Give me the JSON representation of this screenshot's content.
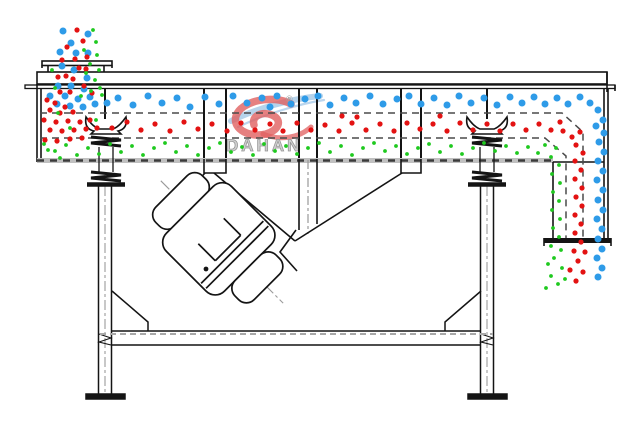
{
  "watermark": {
    "brand": "DAHAN",
    "registered": "®"
  },
  "colors": {
    "line": "#141414",
    "particle_large": "#2E9BE8",
    "particle_medium": "#E31212",
    "particle_small": "#1FC91F",
    "deck_dash": "#4a4a4a",
    "bottom_plate": "#b5b5b5",
    "centerline": "#9a9a9a",
    "watermark_red": "#E06060",
    "watermark_blue": "#A9CBE8",
    "watermark_gray": "#b9b9b9"
  },
  "particles": {
    "large": {
      "r": 3.5,
      "color_key": "particle_large",
      "points": [
        [
          63,
          31
        ],
        [
          88,
          34
        ],
        [
          71,
          43
        ],
        [
          60,
          52
        ],
        [
          76,
          53
        ],
        [
          88,
          53
        ],
        [
          62,
          66
        ],
        [
          74,
          70
        ],
        [
          87,
          78
        ],
        [
          58,
          86
        ],
        [
          71,
          86
        ],
        [
          84,
          89
        ],
        [
          65,
          96
        ],
        [
          78,
          99
        ],
        [
          90,
          97
        ],
        [
          57,
          104
        ],
        [
          70,
          106
        ],
        [
          83,
          107
        ],
        [
          95,
          104
        ],
        [
          107,
          103
        ],
        [
          50,
          96
        ],
        [
          118,
          98
        ],
        [
          133,
          105
        ],
        [
          148,
          96
        ],
        [
          162,
          103
        ],
        [
          177,
          98
        ],
        [
          190,
          107
        ],
        [
          205,
          97
        ],
        [
          219,
          104
        ],
        [
          233,
          96
        ],
        [
          247,
          103
        ],
        [
          262,
          98
        ],
        [
          270,
          107
        ],
        [
          277,
          96
        ],
        [
          291,
          104
        ],
        [
          305,
          99
        ],
        [
          318,
          96
        ],
        [
          330,
          105
        ],
        [
          344,
          98
        ],
        [
          356,
          103
        ],
        [
          370,
          96
        ],
        [
          383,
          104
        ],
        [
          397,
          99
        ],
        [
          409,
          96
        ],
        [
          421,
          104
        ],
        [
          434,
          98
        ],
        [
          447,
          105
        ],
        [
          459,
          96
        ],
        [
          471,
          103
        ],
        [
          484,
          98
        ],
        [
          497,
          105
        ],
        [
          510,
          97
        ],
        [
          522,
          103
        ],
        [
          534,
          97
        ],
        [
          545,
          104
        ],
        [
          557,
          98
        ],
        [
          568,
          104
        ],
        [
          580,
          97
        ],
        [
          590,
          103
        ],
        [
          598,
          110
        ],
        [
          603,
          120
        ],
        [
          596,
          126
        ],
        [
          604,
          133
        ],
        [
          599,
          142
        ],
        [
          604,
          152
        ],
        [
          598,
          161
        ],
        [
          603,
          171
        ],
        [
          597,
          180
        ],
        [
          603,
          190
        ],
        [
          598,
          200
        ],
        [
          603,
          210
        ],
        [
          597,
          219
        ],
        [
          602,
          229
        ],
        [
          598,
          239
        ],
        [
          602,
          249
        ],
        [
          597,
          258
        ],
        [
          602,
          268
        ],
        [
          598,
          277
        ]
      ]
    },
    "medium": {
      "r": 2.6,
      "color_key": "particle_medium",
      "points": [
        [
          77,
          30
        ],
        [
          83,
          41
        ],
        [
          67,
          47
        ],
        [
          75,
          59
        ],
        [
          87,
          57
        ],
        [
          62,
          60
        ],
        [
          79,
          68
        ],
        [
          66,
          76
        ],
        [
          86,
          69
        ],
        [
          58,
          77
        ],
        [
          73,
          79
        ],
        [
          84,
          86
        ],
        [
          60,
          92
        ],
        [
          70,
          92
        ],
        [
          92,
          93
        ],
        [
          47,
          100
        ],
        [
          55,
          103
        ],
        [
          65,
          107
        ],
        [
          50,
          110
        ],
        [
          60,
          113
        ],
        [
          73,
          112
        ],
        [
          44,
          120
        ],
        [
          56,
          122
        ],
        [
          68,
          121
        ],
        [
          80,
          122
        ],
        [
          90,
          120
        ],
        [
          50,
          130
        ],
        [
          62,
          131
        ],
        [
          74,
          130
        ],
        [
          86,
          129
        ],
        [
          97,
          128
        ],
        [
          45,
          140
        ],
        [
          57,
          141
        ],
        [
          70,
          139
        ],
        [
          82,
          138
        ],
        [
          112,
          128
        ],
        [
          127,
          122
        ],
        [
          141,
          130
        ],
        [
          155,
          124
        ],
        [
          170,
          131
        ],
        [
          184,
          122
        ],
        [
          198,
          129
        ],
        [
          212,
          124
        ],
        [
          227,
          131
        ],
        [
          241,
          123
        ],
        [
          255,
          130
        ],
        [
          270,
          124
        ],
        [
          283,
          131
        ],
        [
          297,
          123
        ],
        [
          311,
          130
        ],
        [
          325,
          125
        ],
        [
          339,
          131
        ],
        [
          352,
          123
        ],
        [
          366,
          130
        ],
        [
          380,
          124
        ],
        [
          394,
          131
        ],
        [
          407,
          123
        ],
        [
          420,
          129
        ],
        [
          433,
          124
        ],
        [
          447,
          131
        ],
        [
          460,
          123
        ],
        [
          473,
          130
        ],
        [
          487,
          124
        ],
        [
          500,
          131
        ],
        [
          513,
          124
        ],
        [
          526,
          130
        ],
        [
          539,
          124
        ],
        [
          551,
          130
        ],
        [
          560,
          122
        ],
        [
          342,
          116
        ],
        [
          440,
          116
        ],
        [
          357,
          117
        ],
        [
          563,
          131
        ],
        [
          572,
          137
        ],
        [
          580,
          132
        ],
        [
          576,
          145
        ],
        [
          583,
          153
        ],
        [
          575,
          161
        ],
        [
          581,
          170
        ],
        [
          575,
          179
        ],
        [
          582,
          188
        ],
        [
          576,
          197
        ],
        [
          582,
          206
        ],
        [
          575,
          215
        ],
        [
          581,
          224
        ],
        [
          575,
          233
        ],
        [
          581,
          242
        ],
        [
          574,
          251
        ],
        [
          585,
          252
        ],
        [
          578,
          261
        ],
        [
          570,
          270
        ],
        [
          583,
          272
        ],
        [
          576,
          281
        ]
      ]
    },
    "small": {
      "r": 1.9,
      "color_key": "particle_small",
      "points": [
        [
          93,
          30
        ],
        [
          96,
          42
        ],
        [
          84,
          50
        ],
        [
          97,
          55
        ],
        [
          90,
          64
        ],
        [
          99,
          70
        ],
        [
          86,
          73
        ],
        [
          95,
          80
        ],
        [
          100,
          88
        ],
        [
          52,
          70
        ],
        [
          91,
          91
        ],
        [
          102,
          95
        ],
        [
          55,
          88
        ],
        [
          81,
          96
        ],
        [
          58,
          113
        ],
        [
          96,
          120
        ],
        [
          70,
          128
        ],
        [
          48,
          150
        ],
        [
          60,
          158
        ],
        [
          44,
          144
        ],
        [
          55,
          151
        ],
        [
          66,
          145
        ],
        [
          77,
          155
        ],
        [
          88,
          148
        ],
        [
          99,
          154
        ],
        [
          110,
          144
        ],
        [
          121,
          152
        ],
        [
          132,
          146
        ],
        [
          143,
          155
        ],
        [
          154,
          148
        ],
        [
          165,
          143
        ],
        [
          176,
          152
        ],
        [
          187,
          146
        ],
        [
          198,
          155
        ],
        [
          209,
          148
        ],
        [
          220,
          143
        ],
        [
          231,
          152
        ],
        [
          242,
          147
        ],
        [
          253,
          155
        ],
        [
          264,
          144
        ],
        [
          275,
          151
        ],
        [
          286,
          146
        ],
        [
          297,
          154
        ],
        [
          308,
          148
        ],
        [
          319,
          143
        ],
        [
          330,
          152
        ],
        [
          341,
          146
        ],
        [
          352,
          155
        ],
        [
          363,
          148
        ],
        [
          374,
          143
        ],
        [
          385,
          151
        ],
        [
          396,
          146
        ],
        [
          407,
          154
        ],
        [
          418,
          148
        ],
        [
          429,
          144
        ],
        [
          440,
          152
        ],
        [
          451,
          146
        ],
        [
          462,
          154
        ],
        [
          473,
          148
        ],
        [
          484,
          143
        ],
        [
          495,
          151
        ],
        [
          506,
          146
        ],
        [
          517,
          153
        ],
        [
          528,
          147
        ],
        [
          538,
          153
        ],
        [
          545,
          145
        ],
        [
          556,
          148
        ],
        [
          551,
          157
        ],
        [
          559,
          165
        ],
        [
          552,
          174
        ],
        [
          560,
          183
        ],
        [
          553,
          192
        ],
        [
          559,
          201
        ],
        [
          552,
          210
        ],
        [
          560,
          219
        ],
        [
          553,
          228
        ],
        [
          559,
          237
        ],
        [
          551,
          246
        ],
        [
          561,
          250
        ],
        [
          554,
          258
        ],
        [
          548,
          264
        ],
        [
          562,
          268
        ],
        [
          551,
          276
        ],
        [
          558,
          284
        ],
        [
          565,
          279
        ],
        [
          546,
          288
        ]
      ]
    }
  }
}
